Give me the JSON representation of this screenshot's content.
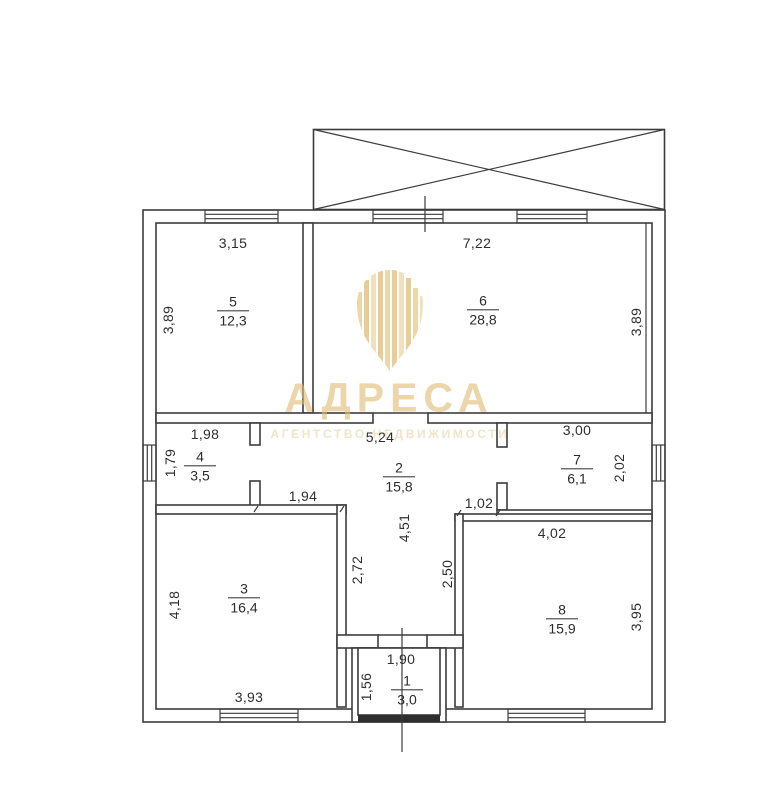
{
  "watermark": {
    "brand": "АДРЕСА",
    "subtitle": "АГЕНТСТВО НЕДВИЖИМОСТИ",
    "gold": "#e0bc73",
    "gold_light": "#eedbb0"
  },
  "plan": {
    "line_color": "#3c3c3c",
    "threshold_color": "#2e2e2e",
    "rooms": {
      "r1": {
        "number": "1",
        "area": "3,0"
      },
      "r2": {
        "number": "2",
        "area": "15,8"
      },
      "r3": {
        "number": "3",
        "area": "16,4"
      },
      "r4": {
        "number": "4",
        "area": "3,5"
      },
      "r5": {
        "number": "5",
        "area": "12,3"
      },
      "r6": {
        "number": "6",
        "area": "28,8"
      },
      "r7": {
        "number": "7",
        "area": "6,1"
      },
      "r8": {
        "number": "8",
        "area": "15,9"
      }
    },
    "dims": {
      "room5_top": "3,15",
      "room5_left": "3,89",
      "room6_top": "7,22",
      "room6_right": "3,89",
      "room4_top": "1,98",
      "room4_left": "1,79",
      "hall_top": "5,24",
      "hall_mid": "4,51",
      "room7_top": "3,00",
      "room7_right": "2,02",
      "shoulder_left": "1,94",
      "shoulder_right": "1,02",
      "corridor_left": "2,72",
      "corridor_right": "2,50",
      "room3_left": "4,18",
      "room3_bottom": "3,93",
      "room8_top": "4,02",
      "room8_right": "3,95",
      "room1_top": "1,90",
      "room1_left": "1,56"
    }
  }
}
